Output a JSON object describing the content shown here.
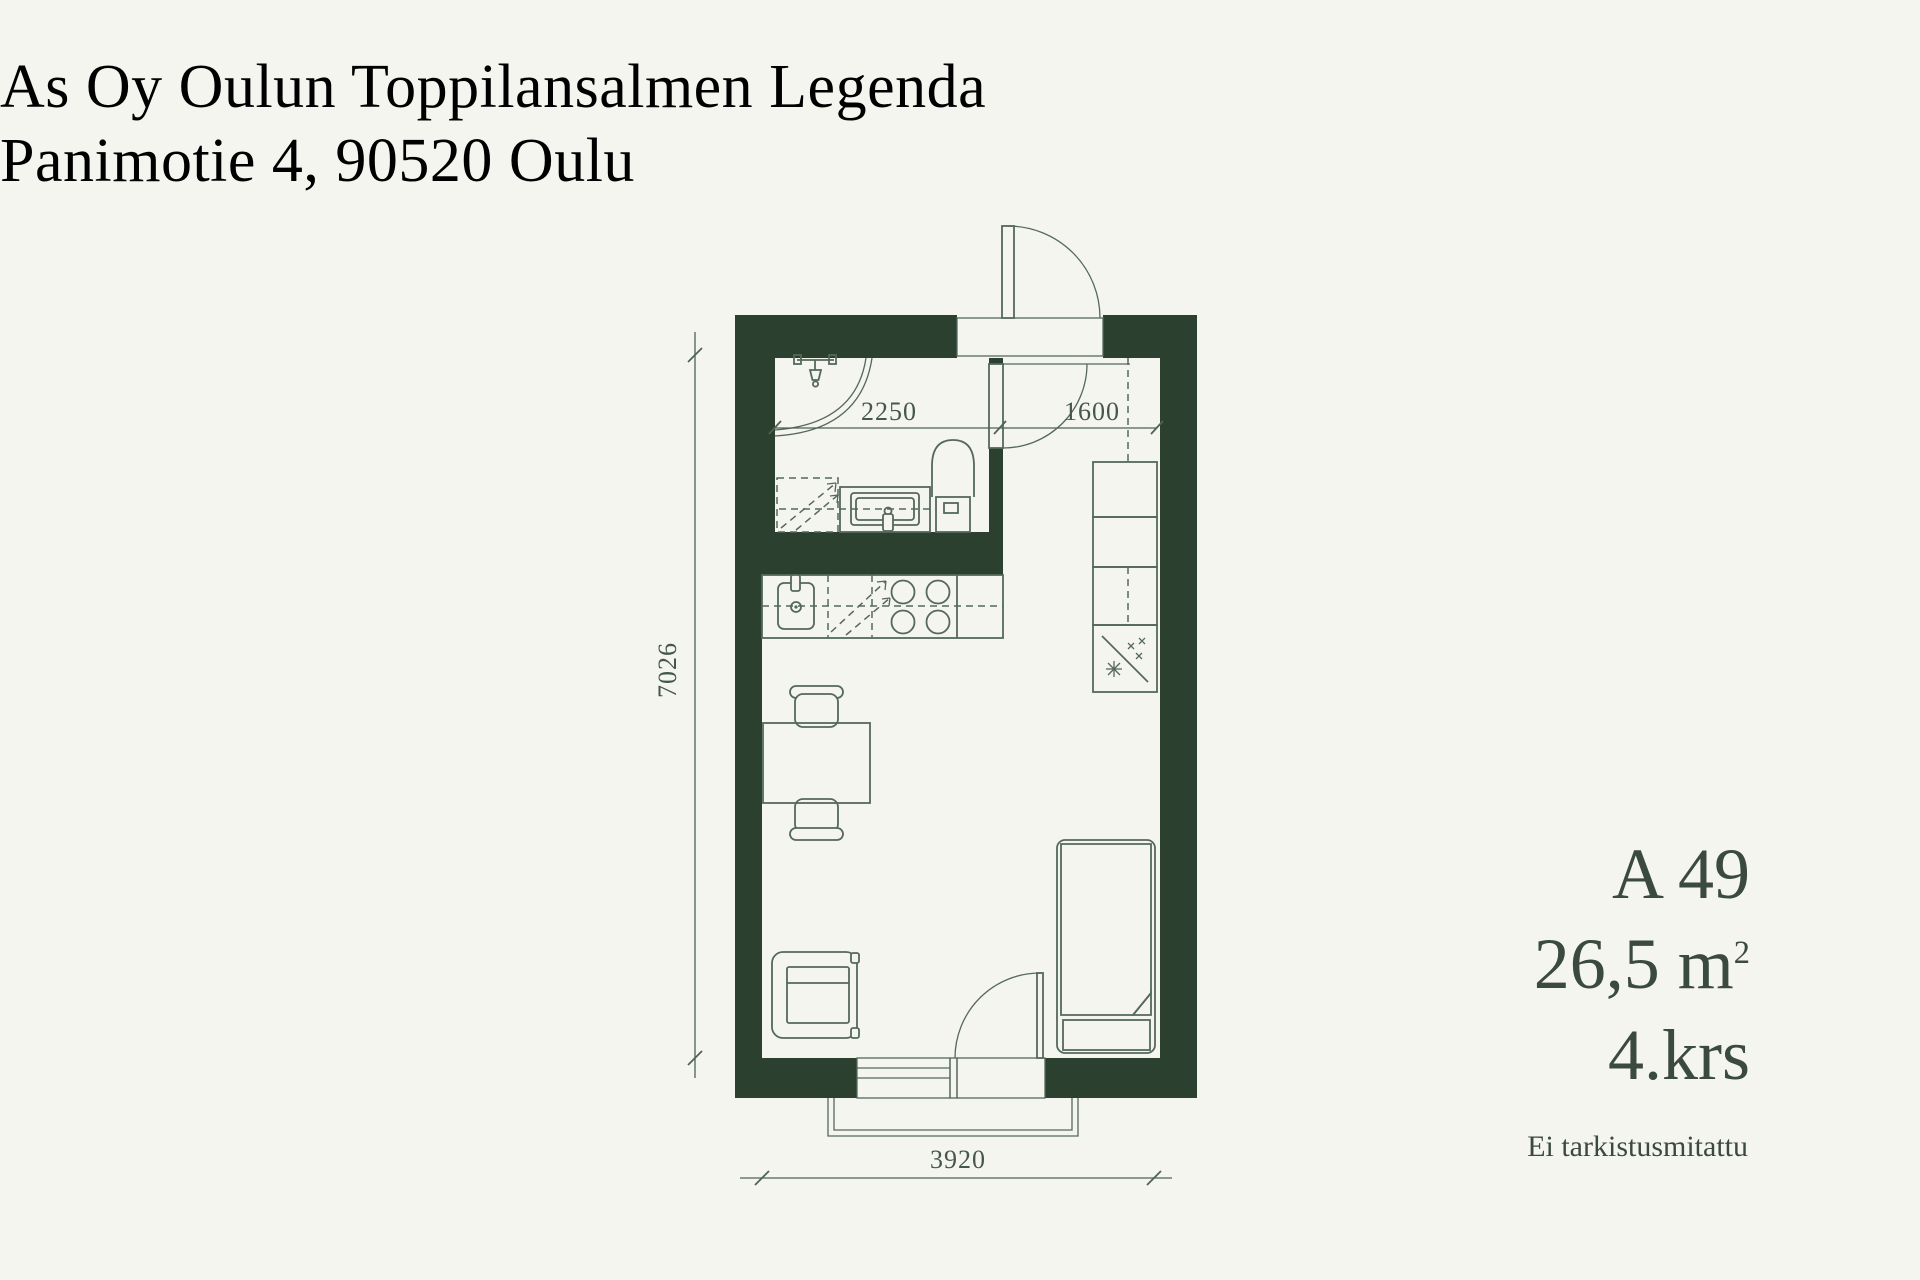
{
  "title": {
    "line1": "As Oy Oulun Toppilansalmen Legenda",
    "line2": "Panimotie 4, 90520 Oulu"
  },
  "unit": {
    "code": "A 49",
    "area": "26,5 m",
    "area_exponent": "2",
    "floor": "4.krs",
    "note": "Ei tarkistusmitattu"
  },
  "dimensions": {
    "bath_width_mm": "2250",
    "hall_width_mm": "1600",
    "length_mm": "7026",
    "width_mm": "3920"
  },
  "colors": {
    "background": "#f5f5ef",
    "wall_fill": "#2c4030",
    "fixture_line": "#55695a",
    "dimension_line": "#4e6353",
    "text": "#3a4a3c"
  }
}
